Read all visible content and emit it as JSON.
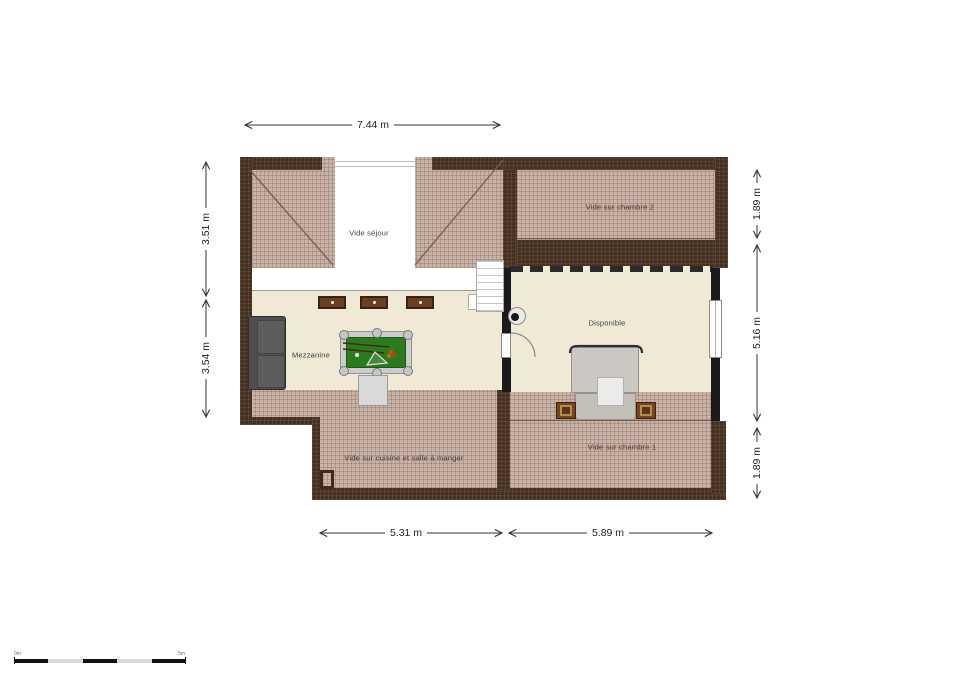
{
  "rooms": {
    "vide_sejour": {
      "label": "Vide séjour"
    },
    "vide_sur_chambre_2": {
      "label": "Vide sur chambre 2"
    },
    "mezzanine": {
      "label": "Mezzanine"
    },
    "disponible": {
      "label": "Disponible"
    },
    "vide_sur_cuisine": {
      "label": "Vide sur cuisine et salle à manger"
    },
    "vide_sur_chambre_1": {
      "label": "Vide sur chambre 1"
    }
  },
  "dimensions": {
    "top_width": "7.44 m",
    "left_upper": "3.51 m",
    "left_lower": "3.54 m",
    "right_upper": "1.89 m",
    "right_middle": "5.16 m",
    "right_lower": "1.89 m",
    "bottom_left": "5.31 m",
    "bottom_right": "5.89 m"
  },
  "scale_bar": {
    "start_label": "0m",
    "end_label": "5m"
  },
  "colors": {
    "wall_dark": "#46301f",
    "hatch_light": "#c9b2a6",
    "floor_cream": "#f0e9d6",
    "interior_wall": "#1b1b1b",
    "pool_felt": "#2c7a20",
    "dim_line": "#333333"
  }
}
